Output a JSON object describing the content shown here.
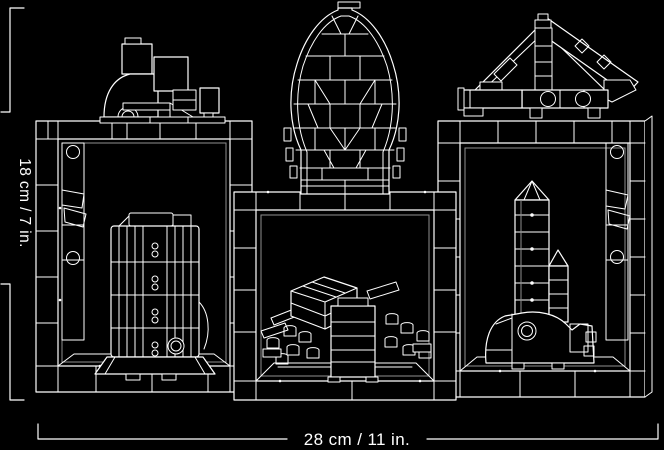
{
  "window": {
    "width": 664,
    "height": 450,
    "background": "#000000"
  },
  "palette": {
    "line": "#ffffff",
    "shadow_line": "#8f8f8f",
    "label_text": "#ffffff"
  },
  "dimensions": {
    "height_label": "18 cm / 7 in.",
    "width_label": "28 cm / 11 in."
  }
}
